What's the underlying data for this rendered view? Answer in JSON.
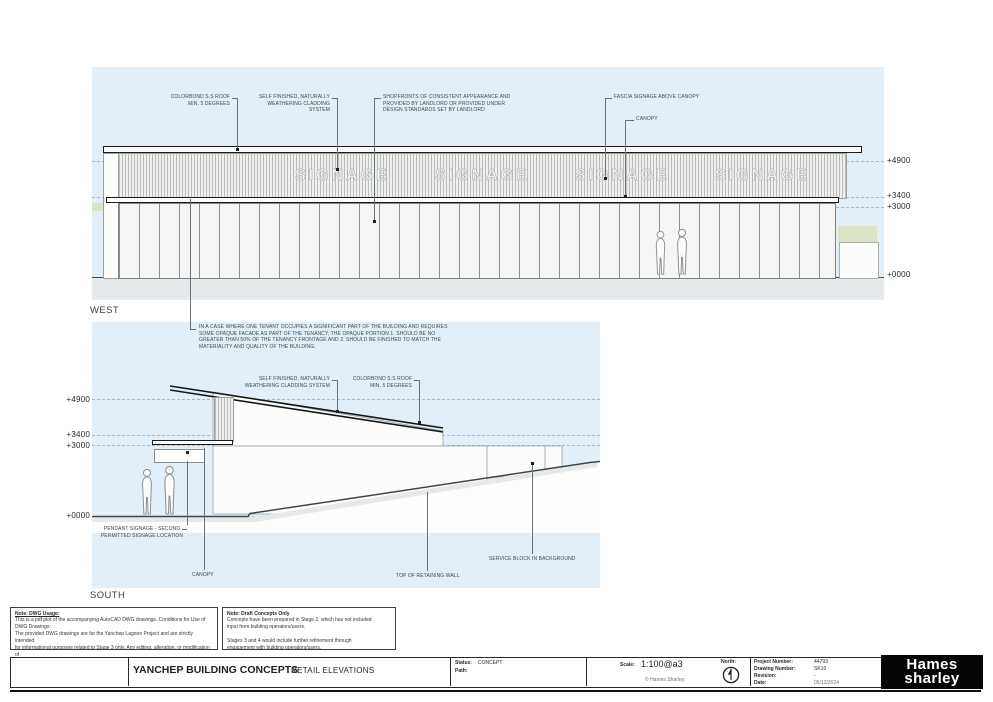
{
  "west": {
    "label": "WEST",
    "signage": "SIGNAGE",
    "levels": [
      "+4900",
      "+3400",
      "+3000",
      "+0000"
    ],
    "ann_colorbond": "COLORBOND S.S ROOF\nMIN. 5 DEGREES",
    "ann_cladding": "SELF FINISHED, NATURALLY\nWEATHERING CLADDING SYSTEM",
    "ann_shopfronts": "SHOPFRONTS OF CONSISTENT APPEARANCE AND\nPROVIDED  BY LANDLORD OR PROVIDED UNDER\nDESIGN STANDARDS SET BY LANDLORD",
    "ann_fascia": "FASCIA SIGNAGE ABOVE CANOPY",
    "ann_canopy": "CANOPY",
    "tenant_note": "IN A CASE WHERE ONE TENANT OCCUPIES A SIGNIFICANT PART OF THE BUILDING AND REQUIRES\nSOME OPAQUE FACADE AS PART OF THE TENANCY, THE OPAQUE PORTION 1. SHOULD BE NO\nGREATER THAN 50% OF THE TENANCY FRONTAGE AND 2. SHOULD BE FINISHED TO MATCH THE\nMATERIALITY AND QUALITY OF THE BUILDING."
  },
  "south": {
    "label": "SOUTH",
    "levels": [
      "+4900",
      "+3400",
      "+3000",
      "+0000"
    ],
    "ann_cladding": "SELF FINISHED, NATURALLY\nWEATHERING CLADDING SYSTEM",
    "ann_colorbond": "COLORBOND S.S ROOF\nMIN. 5 DEGREES",
    "ann_pendant": "PENDANT SIGNAGE - SECOND\nPERMITTED SIGNAGE LOCATION",
    "ann_canopy": "CANOPY",
    "ann_retaining": "TOP OF RETAINING WALL",
    "ann_service": "SERVICE BLOCK IN BACKGROUND"
  },
  "notes": {
    "dwg_title": "Note:  DWG Usage:",
    "dwg_body": "This is a pdf plot of the accompanying AutoCAD DWG drawings. Conditions for Use of\nDWG Drawings:\nThe provided DWG drawings are for the Yanchep Lagoon Project and are strictly intended\nfor informational purposes related to Stage 3 only. Any editing, alteration, or modification of\nthese drawings is prohibited without prior written permission from Hames Sharley.",
    "draft_title": "Note: Draft Concepts Only",
    "draft_body": "Concepts have been prepared in Stage 2, which has not included\ninput from building operators/users.\n\nStages 3 and 4 would include further refinement through\nengagement with building operators/users."
  },
  "titleblock": {
    "project_title": "YANCHEP BUILDING CONCEPTS",
    "sheet_title": "RETAIL ELEVATIONS",
    "status_label": "Status:",
    "status_value": "CONCEPT",
    "path_label": "Path:",
    "scale_label": "Scale:",
    "scale_value": "1:100@a3",
    "copyright": "© Hames Sharley:",
    "north_label": "North:",
    "project_number_label": "Project Number:",
    "project_number": "44793",
    "drawing_number_label": "Drawing Number:",
    "drawing_number": "SK10",
    "revision_label": "Revision:",
    "revision": "-",
    "date_label": "Date:",
    "date": "05/12/2024",
    "logo_line1": "Hames",
    "logo_line2": "sharley"
  },
  "colors": {
    "sky": "#e3eff8",
    "landscape_green": "#dde3c9",
    "ground_gray": "#e6e9e9",
    "linework": "#24282a",
    "logo_background": "#050505"
  }
}
